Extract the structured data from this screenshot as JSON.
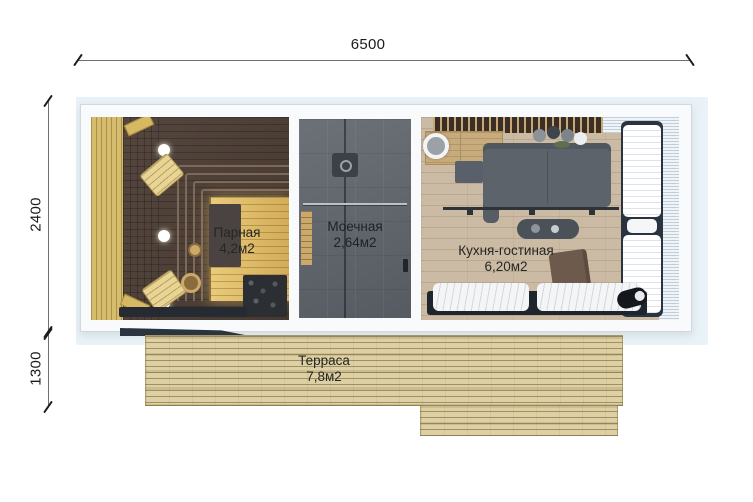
{
  "plan": {
    "type": "floor-plan",
    "dimensions": {
      "total_width_mm": "6500",
      "house_depth_mm": "2400",
      "terrace_depth_mm": "1300"
    },
    "rooms": {
      "sauna": {
        "name": "Парная",
        "area": "4,2м2"
      },
      "washroom": {
        "name": "Моечная",
        "area": "2,64м2"
      },
      "kitchen_living": {
        "name": "Кухня-гостиная",
        "area": "6,20м2"
      },
      "terrace": {
        "name": "Терраса",
        "area": "7,8м2"
      }
    },
    "colors": {
      "halo_blue": "#e9f2f7",
      "wall_white": "#f8fafc",
      "sauna_wood": "#d6bc6d",
      "bench_dark": "#4e4038",
      "wet_room_grey": "#61666d",
      "kitchen_floor": "#ccbba4",
      "terrace_deck": "#dcd0a4",
      "frame_navy": "#2a3340"
    }
  }
}
